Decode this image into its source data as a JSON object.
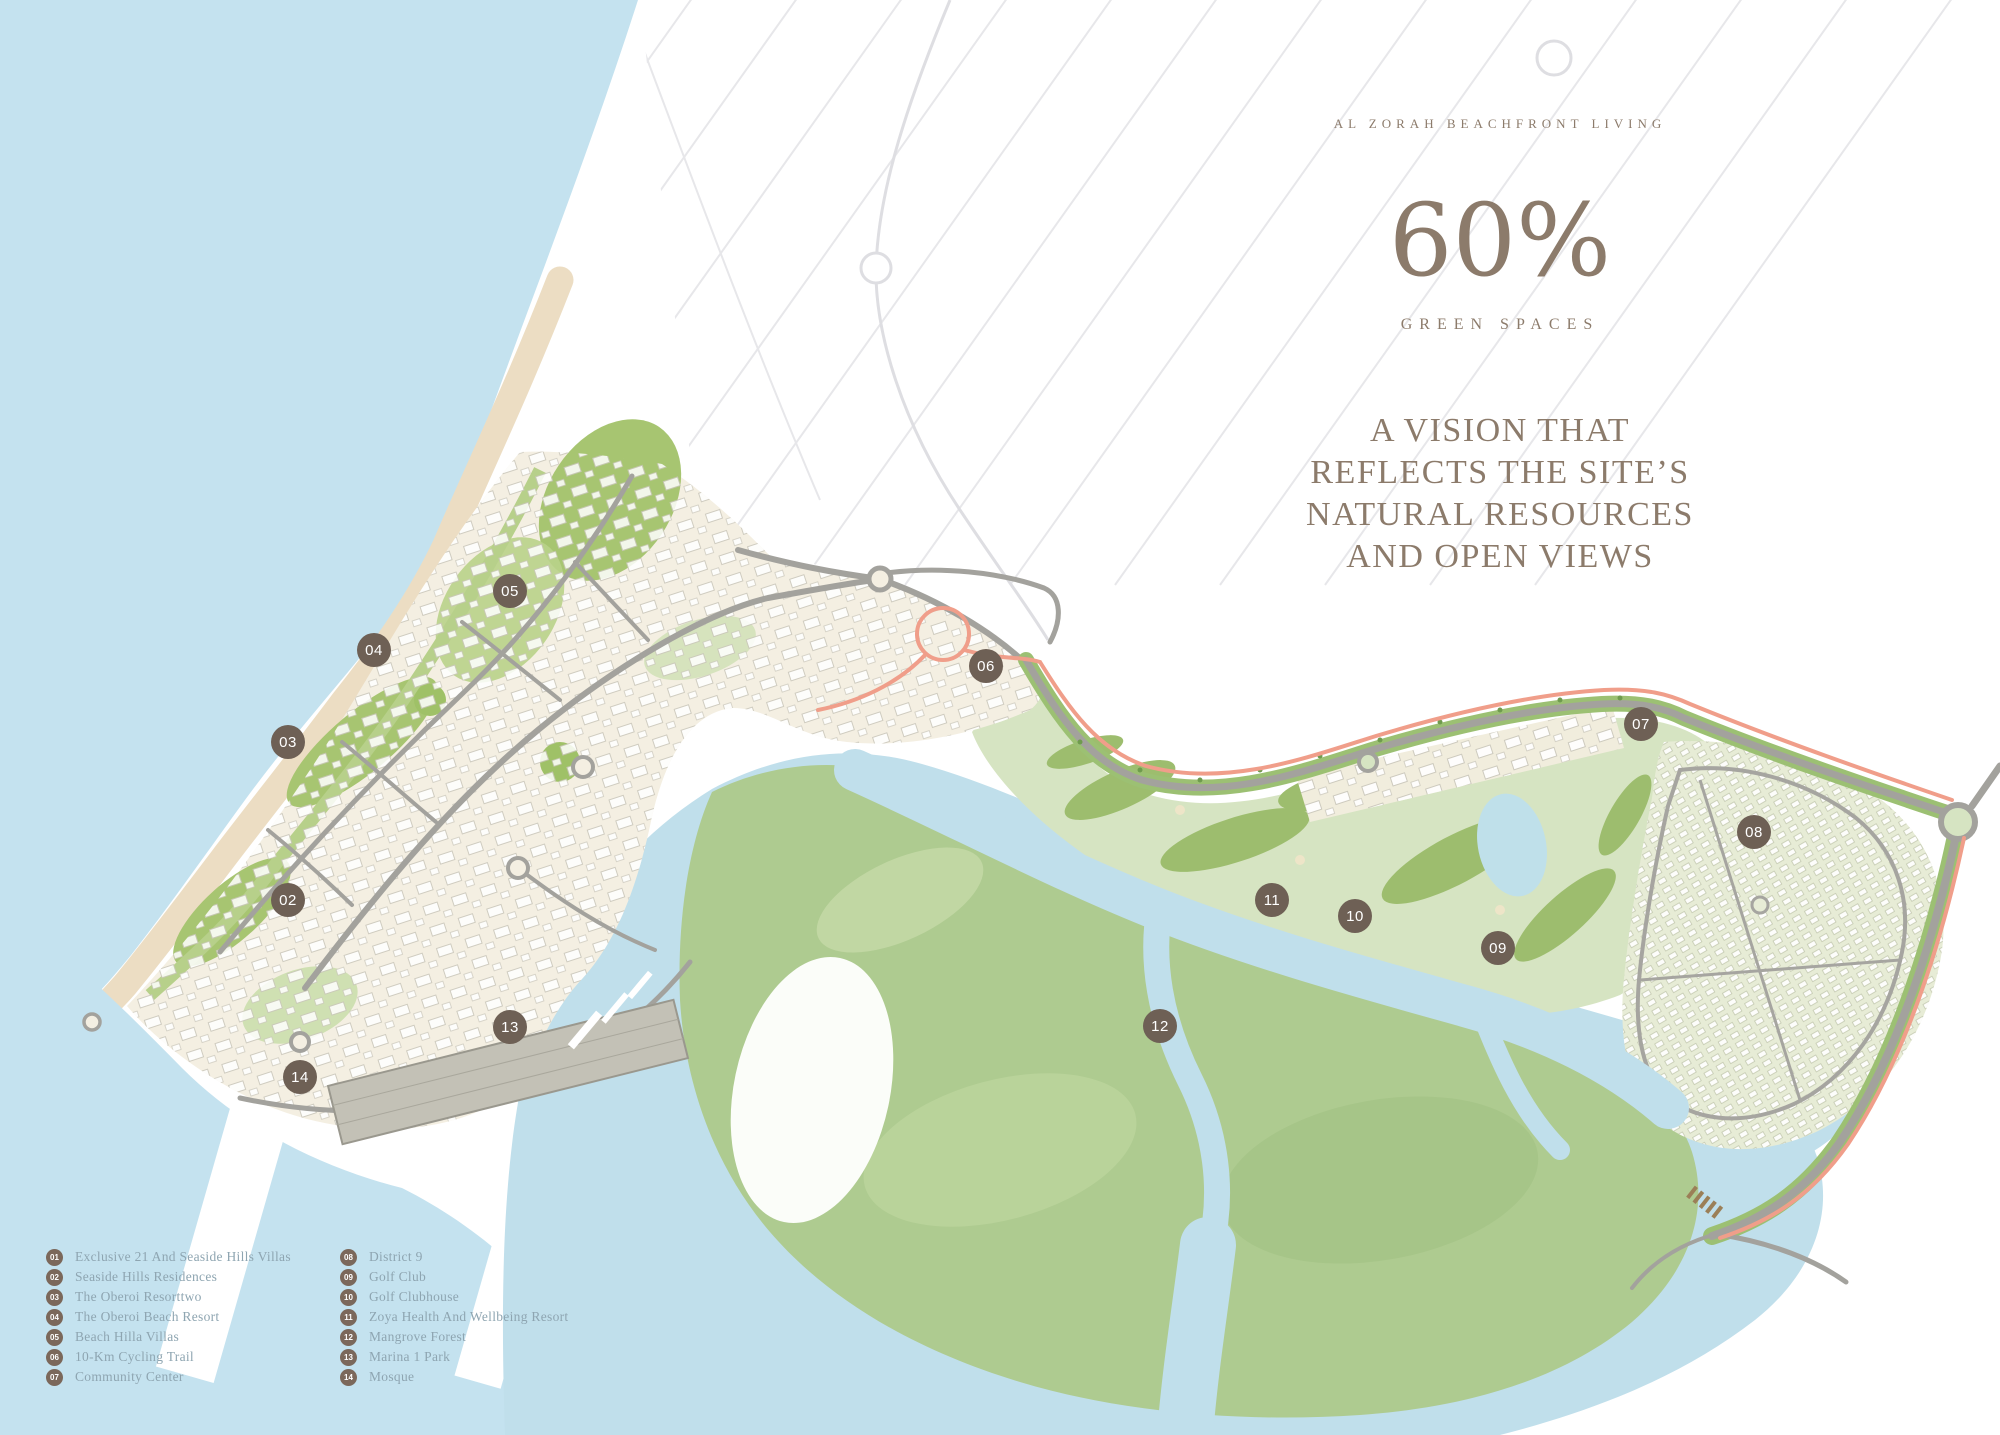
{
  "header": {
    "eyebrow": "AL ZORAH BEACHFRONT LIVING",
    "stat_value": "60%",
    "stat_label": "GREEN SPACES",
    "headline_lines": [
      "A VISION THAT",
      "REFLECTS THE SITE’S",
      "NATURAL RESOURCES",
      "AND OPEN VIEWS"
    ]
  },
  "map": {
    "markers": [
      {
        "number": "02",
        "x": 288,
        "y": 900
      },
      {
        "number": "03",
        "x": 288,
        "y": 742
      },
      {
        "number": "04",
        "x": 374,
        "y": 650
      },
      {
        "number": "05",
        "x": 510,
        "y": 591
      },
      {
        "number": "06",
        "x": 986,
        "y": 666
      },
      {
        "number": "07",
        "x": 1641,
        "y": 724
      },
      {
        "number": "08",
        "x": 1754,
        "y": 832
      },
      {
        "number": "09",
        "x": 1498,
        "y": 948
      },
      {
        "number": "10",
        "x": 1355,
        "y": 916
      },
      {
        "number": "11",
        "x": 1272,
        "y": 900
      },
      {
        "number": "12",
        "x": 1160,
        "y": 1026
      },
      {
        "number": "13",
        "x": 510,
        "y": 1027
      },
      {
        "number": "14",
        "x": 300,
        "y": 1077
      }
    ]
  },
  "legend": {
    "columns": [
      {
        "items": [
          {
            "number": "01",
            "label": "Exclusive 21 And Seaside Hills Villas"
          },
          {
            "number": "02",
            "label": "Seaside Hills Residences"
          },
          {
            "number": "03",
            "label": "The Oberoi Resorttwo"
          },
          {
            "number": "04",
            "label": "The Oberoi Beach Resort"
          },
          {
            "number": "05",
            "label": "Beach Hilla Villas"
          },
          {
            "number": "06",
            "label": "10-Km Cycling Trail"
          },
          {
            "number": "07",
            "label": "Community Center"
          }
        ]
      },
      {
        "items": [
          {
            "number": "08",
            "label": "District 9"
          },
          {
            "number": "09",
            "label": "Golf Club"
          },
          {
            "number": "10",
            "label": "Golf Clubhouse"
          },
          {
            "number": "11",
            "label": "Zoya Health And Wellbeing Resort"
          },
          {
            "number": "12",
            "label": "Mangrove Forest"
          },
          {
            "number": "13",
            "label": "Marina 1 Park"
          },
          {
            "number": "14",
            "label": "Mosque"
          }
        ]
      }
    ]
  },
  "theme": {
    "heading_text": "#8c7b6b",
    "legend_text": "#8ea5b1",
    "legend_circle": "#7b685b",
    "marker_bg": "#6e6055",
    "sea": "#c4e2ef",
    "lagoon": "#c0dfeb",
    "beach": "#ecddc3",
    "development": "#f4efe2",
    "park_green": "#a7c571",
    "golf_base": "#d6e4c2",
    "fairway": "#9dbd6e",
    "mangrove": "#aecb90",
    "road": "#a3a29d",
    "cycling_trail": "#f09e8a"
  }
}
